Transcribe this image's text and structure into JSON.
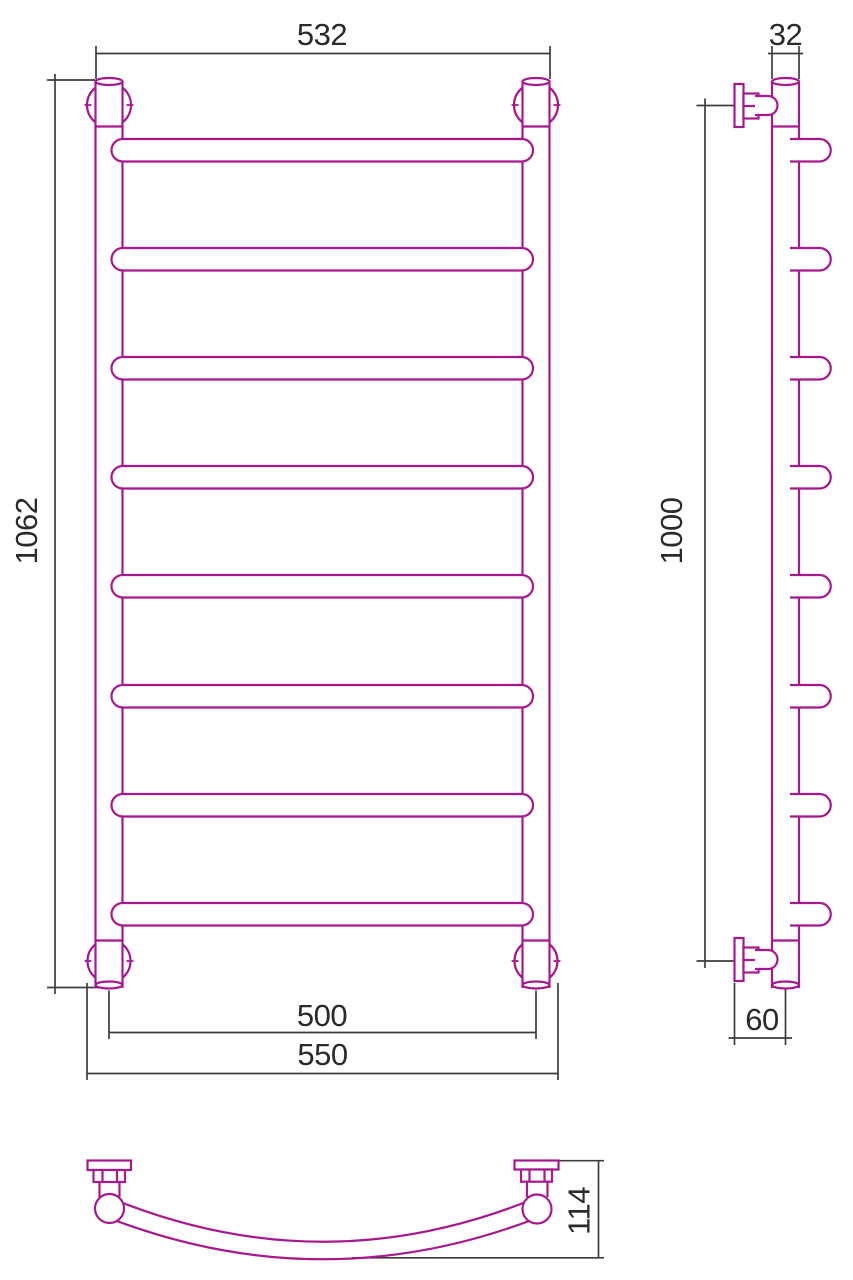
{
  "colors": {
    "outline": "#a6188c",
    "dimension_line": "#3d3d3d",
    "label_text": "#2a2a2a",
    "background": "#ffffff"
  },
  "views": {
    "front": {
      "rung_count": 8,
      "dims": {
        "top_width": "532",
        "height": "1062",
        "bottom_rail_centers": "500",
        "bottom_overall": "550"
      }
    },
    "side": {
      "stub_count": 8,
      "dims": {
        "tube_width": "32",
        "bracket_span": "1000",
        "wall_to_axis": "60"
      }
    },
    "top": {
      "dims": {
        "depth": "114"
      }
    }
  }
}
